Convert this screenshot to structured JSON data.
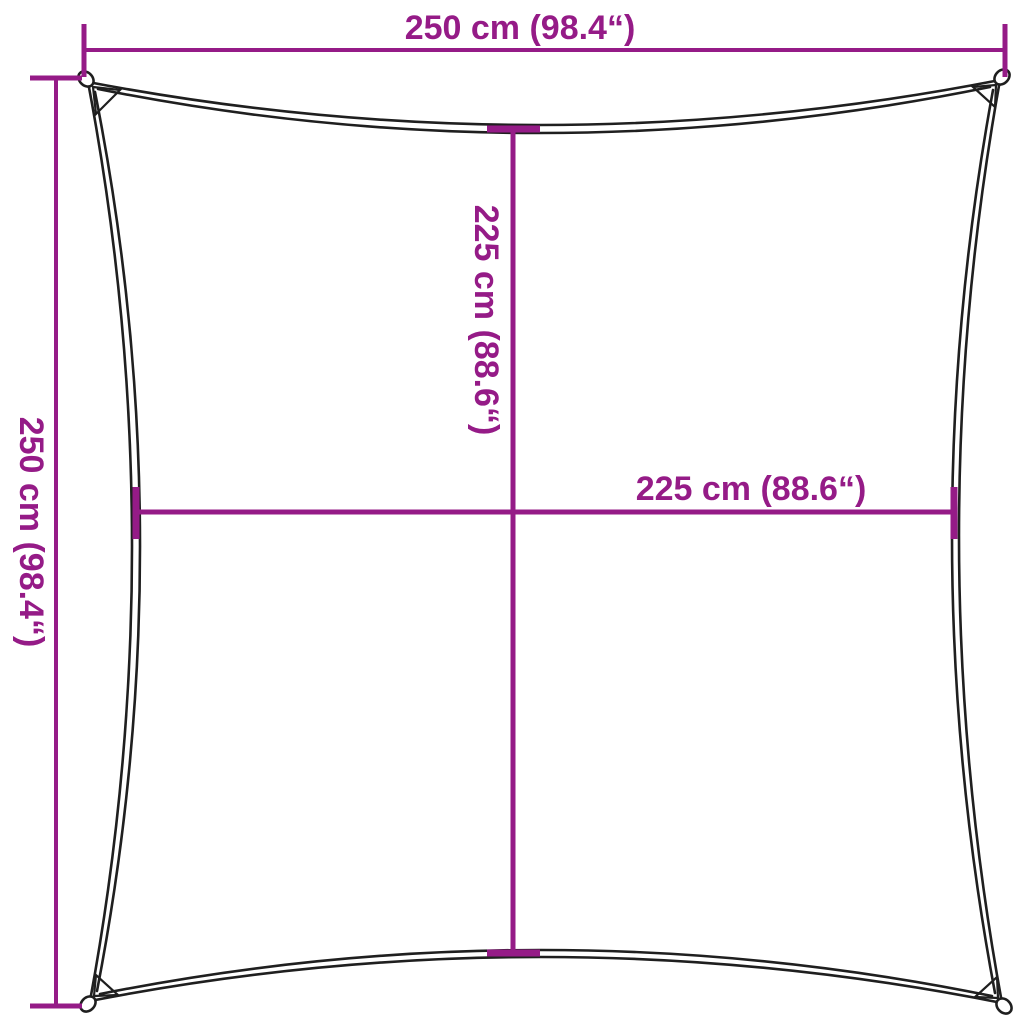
{
  "diagram": {
    "type": "product-dimension-diagram",
    "subject": "square shade sail with concave edges and corner grommet rings",
    "colors": {
      "dimension": "#951b87",
      "outline": "#1f1f1f",
      "background": "#ffffff"
    },
    "dimensions": {
      "top_width_label": "250 cm (98.4“)",
      "left_height_label": "250 cm (98.4“)",
      "inner_vertical_label": "225 cm (88.6“)",
      "inner_horizontal_label": "225 cm (88.6“)"
    },
    "values": {
      "outer_width_cm": 250,
      "outer_width_in": 98.4,
      "outer_height_cm": 250,
      "outer_height_in": 98.4,
      "inner_vertical_cm": 225,
      "inner_vertical_in": 88.6,
      "inner_horizontal_cm": 225,
      "inner_horizontal_in": 88.6
    }
  }
}
